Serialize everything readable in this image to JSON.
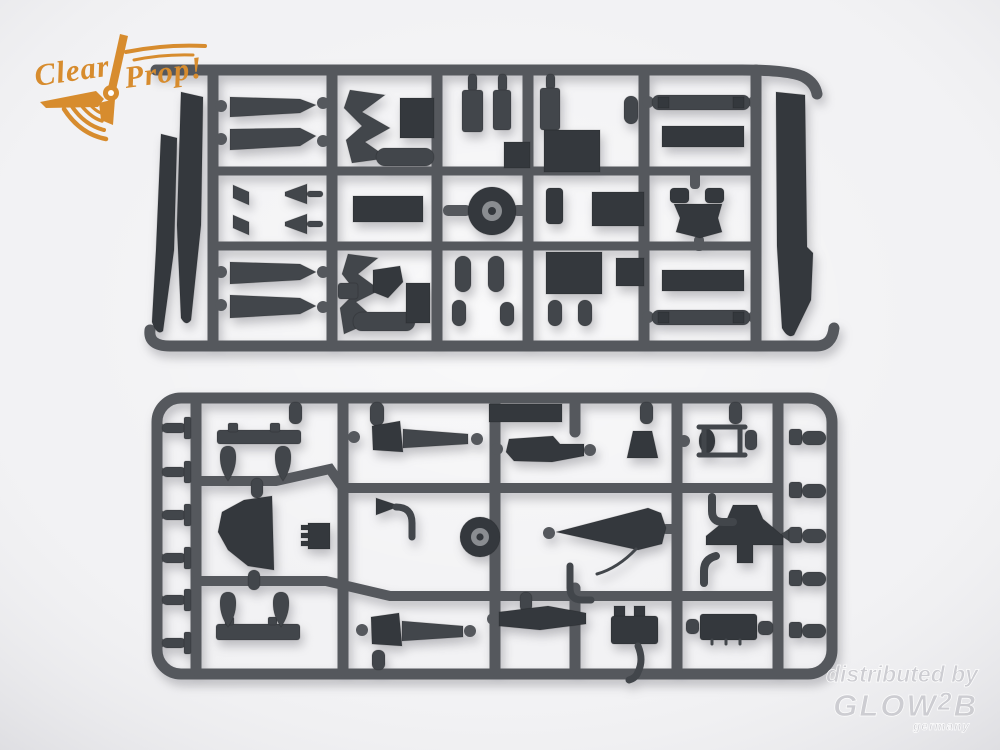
{
  "colors": {
    "background": "#f2f2f4",
    "plastic": "#55585d",
    "plastic_dark": "#42464b",
    "plastic_darker": "#34383d",
    "wheel_hub": "#8a8d91",
    "logo_orange": "#d78c2e",
    "watermark_gray": "#cbcbd0"
  },
  "logo": {
    "word1": "Clear",
    "word2": "Prop!"
  },
  "watermark": {
    "line1": "distributed by",
    "brand_glow": "GLOW",
    "brand_2": "2",
    "brand_b": "B",
    "country": "germany"
  },
  "scene": {
    "sprue_count": 2
  }
}
